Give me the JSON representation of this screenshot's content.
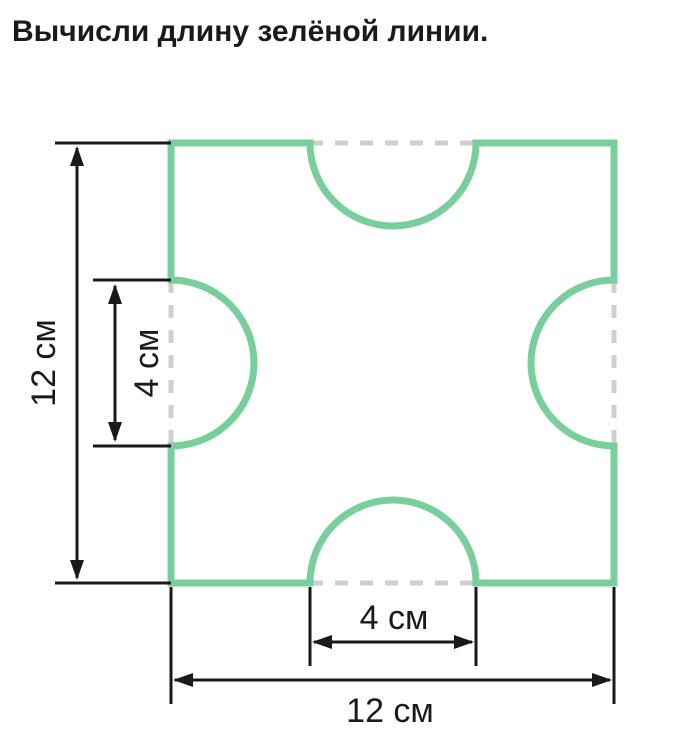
{
  "title": "Вычисли длину зелёной линии.",
  "figure": {
    "shape": "square-with-four-inward-semicircle-notches",
    "values": {
      "square_side_cm": 12,
      "notch_diameter_cm": 4
    },
    "colors": {
      "green": "#79CF9B",
      "dash": "#cfcfcf",
      "dimension": "#1a1a1a"
    },
    "dimensions": {
      "left_outer_label": "12 см",
      "left_inner_label": "4 см",
      "bottom_inner_label": "4 см",
      "bottom_outer_label": "12 см"
    }
  }
}
